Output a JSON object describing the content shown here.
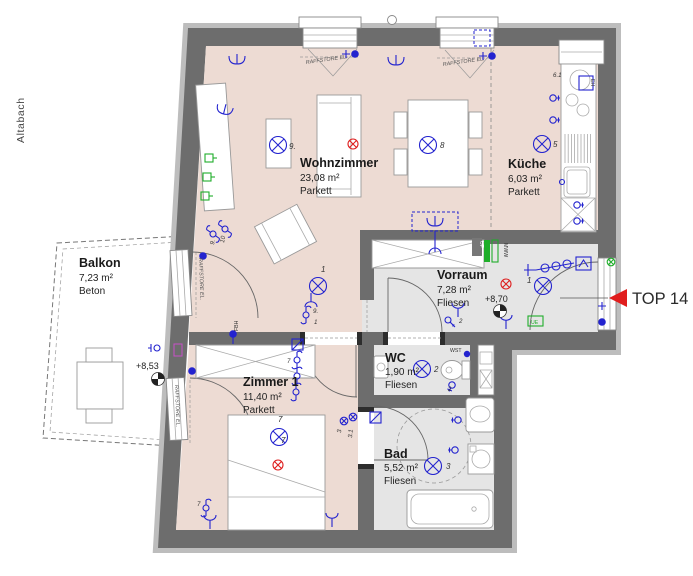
{
  "site": {
    "label": "Altabach"
  },
  "unit": {
    "label": "TOP 14"
  },
  "rooms": {
    "balkon": {
      "name": "Balkon",
      "area": "7,23 m²",
      "floor": "Beton",
      "level": "+8,53"
    },
    "wohnzimmer": {
      "name": "Wohnzimmer",
      "area": "23,08 m²",
      "floor": "Parkett"
    },
    "kueche": {
      "name": "Küche",
      "area": "6,03 m²",
      "floor": "Parkett"
    },
    "vorraum": {
      "name": "Vorraum",
      "area": "7,28 m²",
      "floor": "Fliesen",
      "level": "+8,70"
    },
    "wc": {
      "name": "WC",
      "area": "1,90 m²",
      "floor": "Fliesen"
    },
    "zimmer1": {
      "name": "Zimmer 1",
      "area": "11,40 m²",
      "floor": "Parkett"
    },
    "bad": {
      "name": "Bad",
      "area": "5,52 m²",
      "floor": "Fliesen"
    }
  },
  "shading": {
    "label": "RAFFSTORE EL."
  },
  "tags": {
    "up": "UP",
    "mww": "MWW",
    "fbh": "FBH",
    "wst": "WST",
    "eh": "EH",
    "ue": "UE"
  },
  "electrical": {
    "lamps": {
      "wohnzimmer": "9.",
      "esstisch": "8",
      "kueche": "5",
      "vorraum": "1",
      "wc": "2",
      "bad": "3",
      "zimmer1": "7"
    },
    "switches": {
      "terrace_door": [
        "10",
        "9."
      ],
      "sofa": [
        "9.",
        "1"
      ],
      "zimmer_door": "7",
      "bett": "7",
      "bett_top": "7",
      "bad_door": [
        "3",
        "3.1"
      ],
      "wc_outlet": "2",
      "key": "2",
      "kitchen_unit": "6.1"
    }
  },
  "colors": {
    "parkett": "#eddbd3",
    "fliesen": "#e5e5e5",
    "wall": "#6d6d6d",
    "wall_outer": "#bdbdbd",
    "electric": "#2323cf",
    "signal_green": "#1fae2a",
    "warn_red": "#de1f1f",
    "arrow_red": "#e01d1d"
  }
}
